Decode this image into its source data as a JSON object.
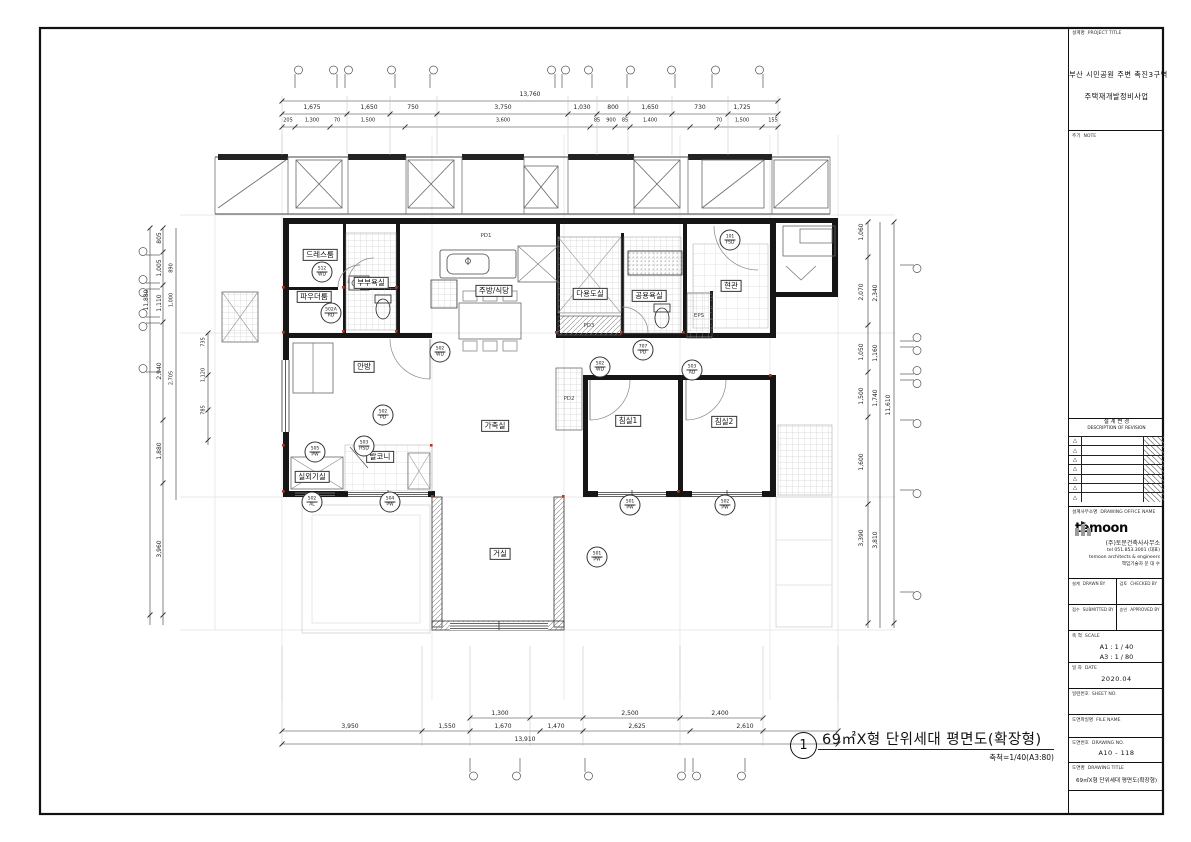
{
  "colors": {
    "line": "#1a1a1a",
    "accent_red": "#b03a2e"
  },
  "caption": {
    "number": "1",
    "title": "69㎡X형 단위세대 평면도(확장형)",
    "scale": "축척=1/40(A3:80)"
  },
  "title_block": {
    "project_label": "설계명",
    "project_label_en": "PROJECT TITLE",
    "project_line1": "부산 시민공원 주변 촉진3구역",
    "project_line2": "주택재개발정비사업",
    "note_label": "주기",
    "note_label_en": "NOTE",
    "revision_label": "설 계 변 경",
    "revision_label_en": "DESCRIPTION OF REVISION",
    "revision_triangle": "△",
    "office_label": "설계사무소명",
    "office_label_en": "DRAWING OFFICE NAME",
    "office_logo": "temoon",
    "office_name": "(주)토문건축사사무소",
    "office_tel": "tel 051.853.3001 (대표)",
    "office_en": "temoon architects & engineers",
    "office_engineer": "책임기술자 문 대 수",
    "drawn_label": "설계",
    "drawn_label_en": "DRAWN BY",
    "checked_label": "검토",
    "checked_label_en": "CHECKED BY",
    "submitted_label": "접수",
    "submitted_label_en": "SUBMITTED BY",
    "approved_label": "승인",
    "approved_label_en": "APPROVED BY",
    "scale_label": "축 척",
    "scale_label_en": "SCALE",
    "scale_a1": "A1 : 1 /  40",
    "scale_a3": "A3 : 1 /  80",
    "date_label": "일 자",
    "date_label_en": "DATE",
    "date_value": "2020.04",
    "sheet_no_label": "일련번호",
    "sheet_no_label_en": "SHEET NO.",
    "file_label": "도면파일명",
    "file_label_en": "FILE NAME",
    "dwg_no_label": "도면번호",
    "dwg_no_label_en": "DRAWING NO.",
    "dwg_no": "A10 - 118",
    "dwg_title_label": "도면명",
    "dwg_title_label_en": "DRAWING TITLE",
    "dwg_title": "69㎡X형 단위세대 평면도(확장형)"
  },
  "rooms": {
    "dress": "드레스룸",
    "powder": "파우더룸",
    "master_bath": "부부욕실",
    "kitchen": "주방/식당",
    "utility": "다용도실",
    "common_bath": "공용욕실",
    "entrance": "현관",
    "master_bed": "안방",
    "family": "가족실",
    "bed1": "침실1",
    "bed2": "침실2",
    "balcony": "발코니",
    "outdoor_unit": "실외기실",
    "living": "거실"
  },
  "shafts": {
    "pd1": "PD1",
    "pd2": "PD2",
    "pd3": "PD3",
    "eps": "EPS"
  },
  "tags": [
    {
      "code": "512",
      "type": "WD"
    },
    {
      "code": "502A",
      "type": "RD"
    },
    {
      "code": "502",
      "type": "WD"
    },
    {
      "code": "707",
      "type": "PD"
    },
    {
      "code": "502",
      "type": "WD"
    },
    {
      "code": "503",
      "type": "AD"
    },
    {
      "code": "101",
      "type": "FSD"
    },
    {
      "code": "502",
      "type": "PD"
    },
    {
      "code": "503",
      "type": "HSD"
    },
    {
      "code": "505",
      "type": "PW"
    },
    {
      "code": "502",
      "type": "AL"
    },
    {
      "code": "504",
      "type": "PW"
    },
    {
      "code": "501",
      "type": "PW"
    },
    {
      "code": "502",
      "type": "PW"
    },
    {
      "code": "501",
      "type": "PW"
    }
  ],
  "dims": {
    "top_total": "13,760",
    "top_row2": [
      "1,675",
      "1,650",
      "750",
      "3,750",
      "1,030",
      "800",
      "1,650",
      "730",
      "1,725"
    ],
    "top_row3": [
      "205",
      "1,300",
      "70",
      "1,500",
      "3,600",
      "85",
      "900",
      "85",
      "1,400",
      "70",
      "1,500",
      "155"
    ],
    "bottom_row1": [
      "1,300",
      "2,500",
      "2,400"
    ],
    "bottom_row2": [
      "3,950",
      "1,550",
      "1,670",
      "1,470",
      "2,625",
      "2,610"
    ],
    "bottom_total": "13,910",
    "left_total": "11,880",
    "left_col": [
      "805",
      "1,005",
      "1,110",
      "2,940",
      "1,880",
      "3,960"
    ],
    "left_sub": [
      "890",
      "1,000",
      "2,705"
    ],
    "left_inner": [
      "735",
      "1,120",
      "785"
    ],
    "right_total": "11,610",
    "right_col1": [
      "1,060",
      "2,070",
      "1,050",
      "1,500",
      "1,600",
      "3,390"
    ],
    "right_col2": [
      "2,340",
      "1,160",
      "1,740",
      "3,810"
    ]
  }
}
